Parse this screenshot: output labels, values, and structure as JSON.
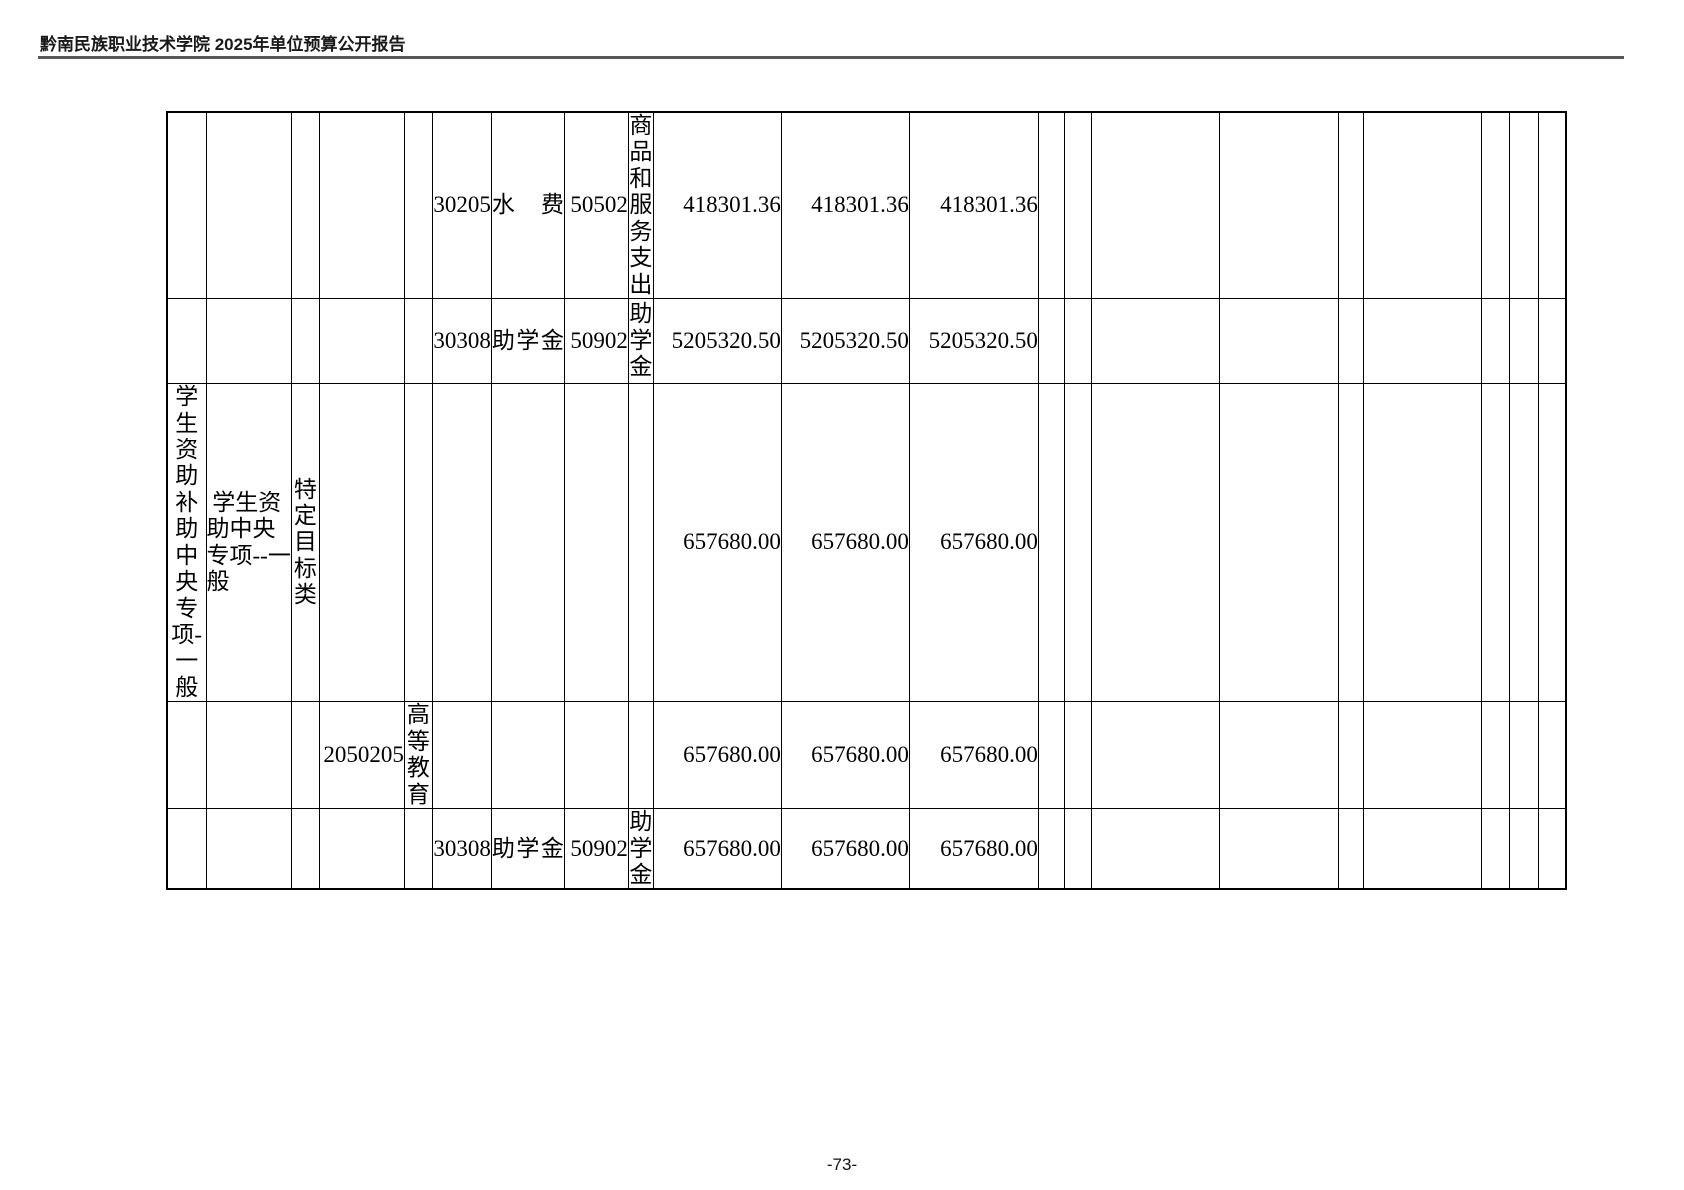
{
  "header": {
    "title": "黔南民族职业技术学院 2025年单位预算公开报告"
  },
  "footer": {
    "page_number": "-73-"
  },
  "table": {
    "cells": [
      {
        "row": 0,
        "col": 5,
        "text": "30205",
        "kind": "code",
        "name": "econ-class-code-cell"
      },
      {
        "row": 0,
        "col": 6,
        "text": "水费",
        "kind": "name",
        "name": "econ-class-name-cell"
      },
      {
        "row": 0,
        "col": 7,
        "text": "50502",
        "kind": "code",
        "name": "gov-econ-class-code-cell"
      },
      {
        "row": 0,
        "col": 8,
        "text": "商\n品\n和\n服\n务\n支\n出",
        "kind": "vert",
        "name": "gov-econ-class-name-cell"
      },
      {
        "row": 0,
        "col": 9,
        "text": "418301.36",
        "kind": "num",
        "name": "amount-cell"
      },
      {
        "row": 0,
        "col": 10,
        "text": "418301.36",
        "kind": "num",
        "name": "amount-cell"
      },
      {
        "row": 0,
        "col": 11,
        "text": "418301.36",
        "kind": "num",
        "name": "amount-cell"
      },
      {
        "row": 1,
        "col": 5,
        "text": "30308",
        "kind": "code",
        "name": "econ-class-code-cell"
      },
      {
        "row": 1,
        "col": 6,
        "text": "助学金",
        "kind": "name",
        "name": "econ-class-name-cell"
      },
      {
        "row": 1,
        "col": 7,
        "text": "50902",
        "kind": "code",
        "name": "gov-econ-class-code-cell"
      },
      {
        "row": 1,
        "col": 8,
        "text": "助\n学\n金",
        "kind": "vert",
        "name": "gov-econ-class-name-cell"
      },
      {
        "row": 1,
        "col": 9,
        "text": "5205320.50",
        "kind": "num",
        "name": "amount-cell"
      },
      {
        "row": 1,
        "col": 10,
        "text": "5205320.50",
        "kind": "num",
        "name": "amount-cell"
      },
      {
        "row": 1,
        "col": 11,
        "text": "5205320.50",
        "kind": "num",
        "name": "amount-cell"
      },
      {
        "row": 2,
        "col": 0,
        "text": "学\n生\n资\n助\n补\n助\n中\n央\n专\n项-\n一\n般",
        "kind": "vert",
        "name": "project-group-name-cell"
      },
      {
        "row": 2,
        "col": 1,
        "text": " 学生资\n助中央\n专项--一\n般",
        "kind": "wrap",
        "name": "project-name-cell"
      },
      {
        "row": 2,
        "col": 2,
        "text": "特\n定\n目\n标\n类",
        "kind": "vert",
        "name": "project-type-cell"
      },
      {
        "row": 2,
        "col": 9,
        "text": "657680.00",
        "kind": "num",
        "name": "amount-cell"
      },
      {
        "row": 2,
        "col": 10,
        "text": "657680.00",
        "kind": "num",
        "name": "amount-cell"
      },
      {
        "row": 2,
        "col": 11,
        "text": "657680.00",
        "kind": "num",
        "name": "amount-cell"
      },
      {
        "row": 3,
        "col": 3,
        "text": "2050205",
        "kind": "code",
        "name": "function-class-code-cell"
      },
      {
        "row": 3,
        "col": 4,
        "text": "高\n等\n教\n育",
        "kind": "vert",
        "name": "function-class-name-cell"
      },
      {
        "row": 3,
        "col": 9,
        "text": "657680.00",
        "kind": "num",
        "name": "amount-cell"
      },
      {
        "row": 3,
        "col": 10,
        "text": "657680.00",
        "kind": "num",
        "name": "amount-cell"
      },
      {
        "row": 3,
        "col": 11,
        "text": "657680.00",
        "kind": "num",
        "name": "amount-cell"
      },
      {
        "row": 4,
        "col": 5,
        "text": "30308",
        "kind": "code",
        "name": "econ-class-code-cell"
      },
      {
        "row": 4,
        "col": 6,
        "text": "助学金",
        "kind": "name",
        "name": "econ-class-name-cell"
      },
      {
        "row": 4,
        "col": 7,
        "text": "50902",
        "kind": "code",
        "name": "gov-econ-class-code-cell"
      },
      {
        "row": 4,
        "col": 8,
        "text": "助\n学\n金",
        "kind": "vert",
        "name": "gov-econ-class-name-cell"
      },
      {
        "row": 4,
        "col": 9,
        "text": "657680.00",
        "kind": "num",
        "name": "amount-cell"
      },
      {
        "row": 4,
        "col": 10,
        "text": "657680.00",
        "kind": "num",
        "name": "amount-cell"
      },
      {
        "row": 4,
        "col": 11,
        "text": "657680.00",
        "kind": "num",
        "name": "amount-cell"
      }
    ]
  }
}
